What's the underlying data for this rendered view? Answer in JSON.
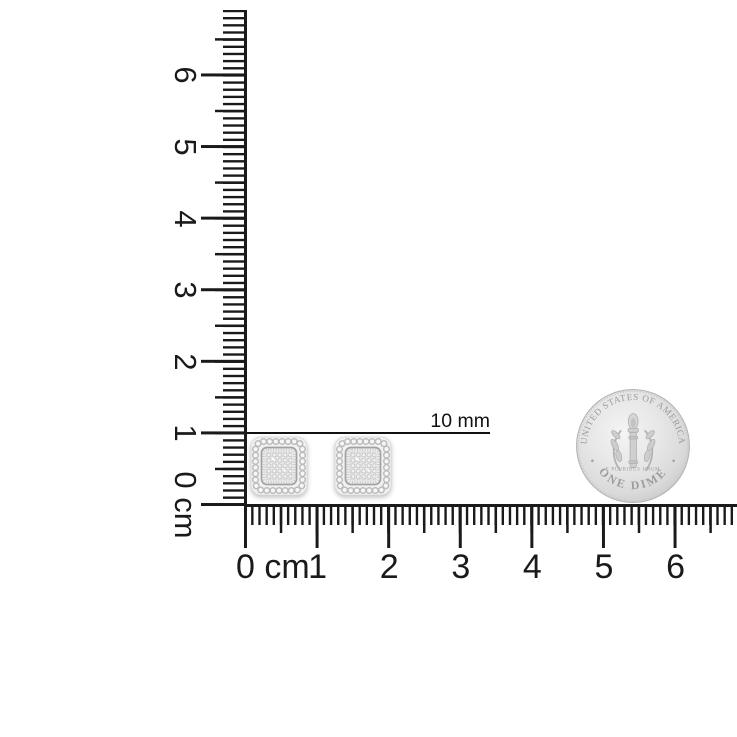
{
  "rulers": {
    "unit": "cm",
    "color": "#1a1a1a",
    "cm_pixel_spacing": 71.6,
    "vertical_labels": [
      "0 cm",
      "1",
      "2",
      "3",
      "4",
      "5",
      "6"
    ],
    "horizontal_labels": [
      "0 cm",
      "1",
      "2",
      "3",
      "4",
      "5",
      "6"
    ]
  },
  "measurement": {
    "label": "10 mm"
  },
  "coin": {
    "legend_top": "UNITED STATES OF AMERICA",
    "legend_bottom": "ONE DIME",
    "motto": "E PLURIBUS UNUM",
    "face_color": "#e2e2e2",
    "engraving_color": "#9c9c9c"
  },
  "earrings": {
    "count": 2,
    "metal_color": "#f1f1f1",
    "frame_color": "#a2a2a2",
    "bead_color": "#bcbcbc"
  }
}
